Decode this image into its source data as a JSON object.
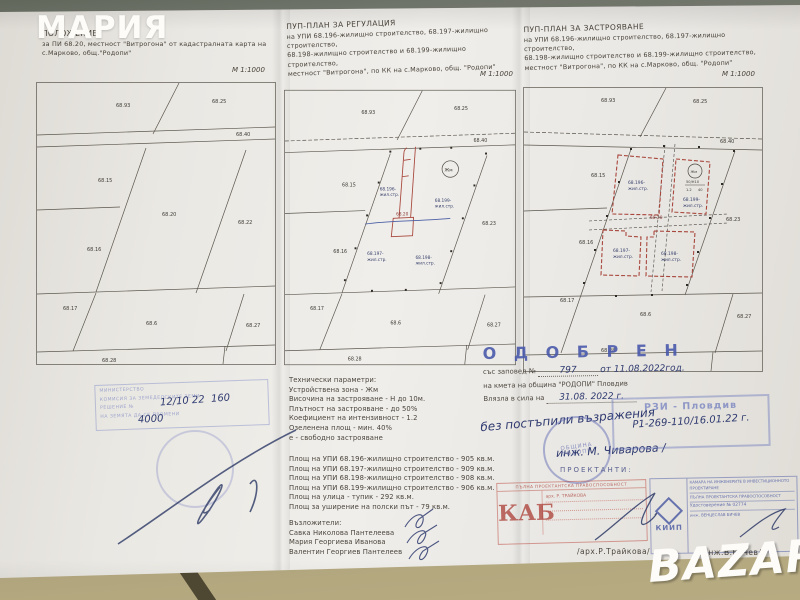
{
  "watermark": {
    "top": "МАРИЯ",
    "bottom": "BAZAR"
  },
  "p1": {
    "t1": "ПОЛОЖЕНИЕ",
    "t2": "за ПИ 68.20, местност \"Витрогона\" от кадастралната карта на",
    "t3": "с.Марково, общ.\"Родопи\"",
    "scale": "М 1:1000",
    "L": {
      "a": "68.93",
      "b": "68.25",
      "road": "68.40",
      "c": "68.15",
      "d": "68.20",
      "e": "68.22",
      "f": "68.16",
      "g": "68.17",
      "h": "68.6",
      "i": "68.27",
      "j": "68.28"
    }
  },
  "p2": {
    "t1": "ПУП-ПЛАН ЗА РЕГУЛАЦИЯ",
    "t2": "на УПИ 68.196-жилищно строителство, 68.197-жилищно строителство,",
    "t3": "68.198-жилищно строителство и 68.199-жилищно строителство,",
    "t4": "местност \"Витрогона\", по КК на с.Марково, общ. \"Родопи\"",
    "scale": "М 1:1000",
    "L": {
      "a": "68.93",
      "b": "68.25",
      "road": "68.40",
      "c": "68.15",
      "e": "68.23",
      "f": "68.16",
      "g": "68.17",
      "h": "68.6",
      "i": "68.27",
      "j": "68.28",
      "street": "68.20",
      "zone": "Жм",
      "u196a": "68.196-",
      "u196b": "жил.стр.",
      "u197a": "68.197-",
      "u197b": "жил.стр.",
      "u198a": "68.198-",
      "u198b": "жил.стр.",
      "u199a": "68.199-",
      "u199b": "жил.стр."
    }
  },
  "p3": {
    "t1": "ПУП-ПЛАН ЗА ЗАСТРОЯВАНЕ",
    "t2": "на УПИ 68.196-жилищно строителство, 68.197-жилищно строителство,",
    "t3": "68.198-жилищно строителство и 68.199-жилищно строителство,",
    "t4": "местност \"Витрогона\", по КК на с.Марково, общ. \"Родопи\"",
    "scale": "М 1:1000",
    "L": {
      "a": "68.93",
      "b": "68.25",
      "road": "68.40",
      "c": "68.15",
      "e": "68.23",
      "f": "68.16",
      "g": "68.17",
      "h": "68.6",
      "i": "68.27",
      "j": "68.28",
      "street": "68.20",
      "zone": "Жм",
      "z1": "50/Н10",
      "z2": "1.2",
      "z3": "40",
      "u196a": "68.196-",
      "u196b": "жил.стр.",
      "u197a": "68.197-",
      "u197b": "жил.стр.",
      "u198a": "68.198-",
      "u198b": "жил.стр.",
      "u199a": "68.199-",
      "u199b": "жил.стр."
    }
  },
  "tech": {
    "heading": "Технически параметри:",
    "l1": "Устройствена зона - Жм",
    "l2": "Височина на застрояване - Н до 10м.",
    "l3": "Плътност на застрояване - до 50%",
    "l4": "Коефициент на интензивност - 1.2",
    "l5": "Озеленена площ - мин. 40%",
    "l6": "е - свободно застрояване"
  },
  "areas": {
    "l1": "Площ на УПИ 68.196-жилищно строителство - 905 кв.м.",
    "l2": "Площ на УПИ 68.197-жилищно строителство - 909 кв.м.",
    "l3": "Площ на УПИ 68.198-жилищно строителство - 908 кв.м.",
    "l4": "Площ на УПИ 68.199-жилищно строителство - 906 кв.м.",
    "l5": "Площ на улица - тупик - 292 кв.м.",
    "l6": "Площ за уширение на полски път - 79 кв.м."
  },
  "clients": {
    "heading": "Възложители:",
    "n1": "Савка Николова Пантелеева",
    "n2": "Мария Георгиева Иванова",
    "n3": "Валентин Георгиев Пантелеев"
  },
  "approval": {
    "title": "О Д О Б Р Е Н",
    "a1": "със заповед №",
    "no": "797",
    "a2": "от 11.08.2022год.",
    "b": "на кмета на община \"РОДОПИ\" Пловдив",
    "c": "Влязла в сила на",
    "date": "31.08. 2022 г.",
    "note": "без постъпили възражения",
    "stamp": "ОБЩИНА РОДОПИ",
    "signer": "инж. М. Чиварова /",
    "label": "ПРОЕКТАНТИ:"
  },
  "kab": {
    "header": "ПЪЛНА ПРОЕКТАНТСКА ПРАВОСПОСОБНОСТ",
    "logo": "КАБ",
    "name": "арх. Р. ТРАЙКОВА",
    "caption": "/арх.Р.Трайкова/"
  },
  "rzi": {
    "title": "РЗИ - Пловдив",
    "ref": "Р1-269-110/16.01.22 г."
  },
  "kiip": {
    "logo": "КИИП",
    "l1": "КАМАРА НА ИНЖЕНЕРИТЕ В ИНВЕСТИЦИОННОТО ПРОЕКТИРАНЕ",
    "l2": "ПЪЛНА ПРОЕКТАНТСКА ПРАВОСПОСОБНОСТ",
    "cert": "Удостоверение № 02774",
    "name": "инж. ВЕНЦЕСЛАВ БИЧЕВ",
    "caption": "/инж.В.Бичев/"
  },
  "ministry": {
    "l1": "МИНИСТЕРСТВО",
    "l2": "КОМИСИЯ ЗА ЗЕМЕДЕЛСКИТЕ ЗЕМИ",
    "l3": "РЕШЕНИЕ №",
    "l4": "НА ЗЕМЯТА ДА СЕ ПРОМЕНИ",
    "d1": "12/10 22",
    "d2": "160",
    "d3": "4000"
  }
}
